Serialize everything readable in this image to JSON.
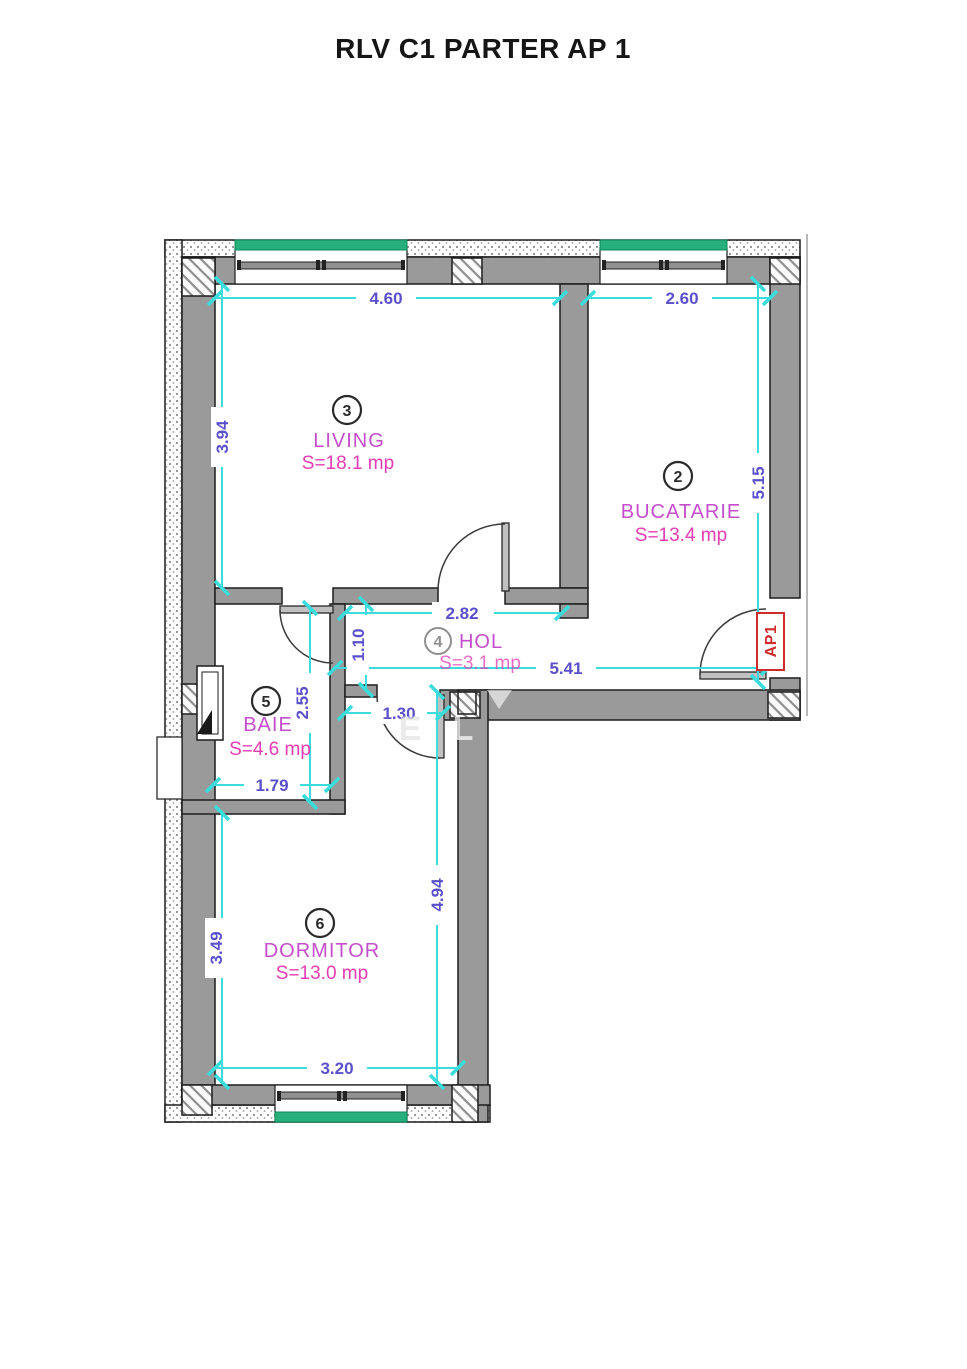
{
  "title": "RLV C1 PARTER AP 1",
  "apartment_label": "AP1",
  "rooms": {
    "bucatarie": {
      "number": "2",
      "name": "BUCATARIE",
      "area": "S=13.4 mp"
    },
    "living": {
      "number": "3",
      "name": "LIVING",
      "area": "S=18.1 mp"
    },
    "hol": {
      "number": "4",
      "name": "HOL",
      "area": "S=3.1 mp"
    },
    "baie": {
      "number": "5",
      "name": "BAIE",
      "area": "S=4.6 mp"
    },
    "dormitor": {
      "number": "6",
      "name": "DORMITOR",
      "area": "S=13.0 mp"
    }
  },
  "dimensions": {
    "living_width": "4.60",
    "bucatarie_width": "2.60",
    "living_height": "3.94",
    "bucatarie_height": "5.15",
    "hol_width": "2.82",
    "hol_depth": "1.10",
    "hol_length": "5.41",
    "baie_height": "2.55",
    "nook_width": "1.30",
    "baie_width": "1.79",
    "dormitor_height_right": "4.94",
    "dormitor_height_left": "3.49",
    "dormitor_width": "3.20"
  },
  "watermark": {
    "e": "E",
    "l": "L"
  },
  "colors": {
    "dimension_line": "#3cdcdc",
    "dimension_text": "#5b50cb",
    "room_name_text": "#c44ecb",
    "room_area_text": "#e43cb2",
    "entrance_label": "#cf2c2c",
    "wall_fill": "#9a9a9a",
    "window_glass": "#27b07e"
  }
}
